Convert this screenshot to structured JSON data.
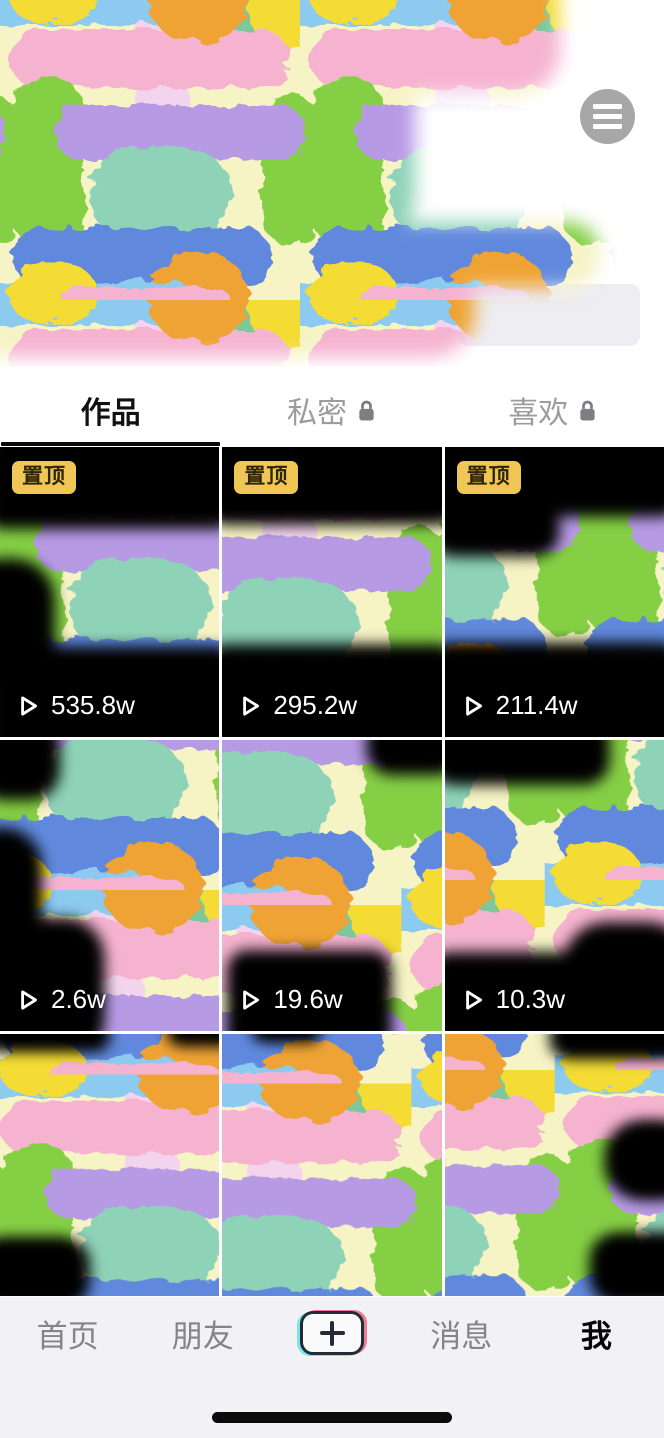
{
  "profile_header": {
    "menu_button_icon": "hamburger-menu-icon",
    "note": "profile info obscured by paint strokes"
  },
  "tabs": {
    "items": [
      {
        "label": "作品",
        "active": true,
        "locked": false
      },
      {
        "label": "私密",
        "active": false,
        "locked": true
      },
      {
        "label": "喜欢",
        "active": false,
        "locked": true
      }
    ]
  },
  "grid": {
    "pinned_badge_label": "置顶",
    "play_icon": "play-outline-icon",
    "tiles": [
      {
        "pinned": true,
        "play_count": "535.8w"
      },
      {
        "pinned": true,
        "play_count": "295.2w"
      },
      {
        "pinned": true,
        "play_count": "211.4w"
      },
      {
        "pinned": false,
        "play_count": "2.6w"
      },
      {
        "pinned": false,
        "play_count": "19.6w"
      },
      {
        "pinned": false,
        "play_count": "10.3w"
      },
      {
        "pinned": false,
        "play_count": ""
      },
      {
        "pinned": false,
        "play_count": ""
      },
      {
        "pinned": false,
        "play_count": ""
      }
    ]
  },
  "bottom_nav": {
    "items": [
      {
        "label": "首页",
        "active": false
      },
      {
        "label": "朋友",
        "active": false
      },
      {
        "label": "消息",
        "active": false
      },
      {
        "label": "我",
        "active": true
      }
    ],
    "create_button_icon": "plus-icon"
  },
  "colors": {
    "pinned_badge_bg": "#f0c654",
    "nav_bg": "#f2f1f5",
    "nav_inactive_text": "#84848a",
    "active_text": "#000000",
    "menu_circle": "#a7a7a9",
    "paint_palette": [
      "#f5b3d0",
      "#f3d3ee",
      "#85cf45",
      "#b79ae4",
      "#8ed2b8",
      "#f4dc35",
      "#6189dd",
      "#efa335",
      "#8ccaf0",
      "#f6f3c5",
      "#7cc79c"
    ]
  }
}
